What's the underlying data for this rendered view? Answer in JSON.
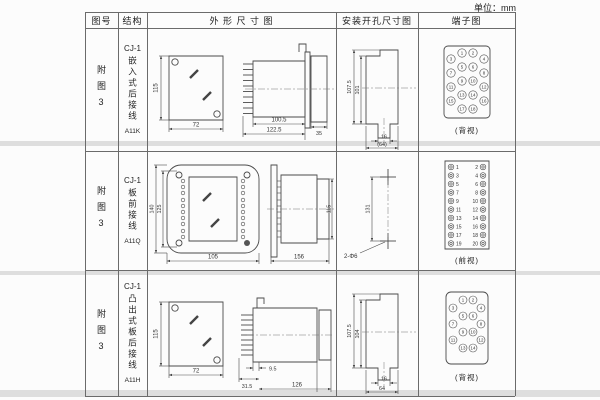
{
  "unit_label": "单位：mm",
  "header": {
    "fig_no": "图号",
    "structure": "结构",
    "outline": "外 形 尺 寸 图",
    "mounting": "安装开孔尺寸图",
    "terminal": "端子图"
  },
  "rows": [
    {
      "fig_no": "附图3",
      "model": "CJ-1",
      "structure_type": "嵌入式后接线",
      "code": "A11K",
      "outline": {
        "front_height": "115",
        "front_width": "72",
        "depth_inner": "100.5",
        "depth_outer": "122.5",
        "bezel_depth": "35"
      },
      "mounting": {
        "outer_height": "107.5",
        "inner_height": "101",
        "tab": "16",
        "width": "(64)"
      },
      "terminal": {
        "view_label": "(背视)",
        "numbers": [
          "1",
          "2",
          "3",
          "4",
          "5",
          "6",
          "7",
          "8",
          "9",
          "10",
          "11",
          "12",
          "13",
          "14",
          "15",
          "16",
          "17",
          "18"
        ]
      }
    },
    {
      "fig_no": "附图3",
      "model": "CJ-1",
      "structure_type": "板前接线",
      "code": "A11Q",
      "outline": {
        "front_height_outer": "140",
        "front_height_inner": "125",
        "front_width": "105",
        "depth": "156",
        "side_height": "115"
      },
      "mounting": {
        "hole_spacing": "131",
        "holes_label": "2-Φ6"
      },
      "terminal": {
        "view_label": "(前视)",
        "left_numbers": [
          "1",
          "3",
          "5",
          "7",
          "9",
          "11",
          "13",
          "15",
          "17",
          "19"
        ],
        "right_numbers": [
          "2",
          "4",
          "6",
          "8",
          "10",
          "12",
          "14",
          "16",
          "18",
          "20"
        ]
      }
    },
    {
      "fig_no": "附图3",
      "model": "CJ-1",
      "structure_type": "凸出式板后接线",
      "code": "A11H",
      "outline": {
        "front_height": "115",
        "front_width": "72",
        "stud_length": "31.5",
        "offset": "9.5",
        "depth": "126"
      },
      "mounting": {
        "outer_height": "107.5",
        "inner_height": "104",
        "tab": "16",
        "width": "64"
      },
      "terminal": {
        "view_label": "(背视)",
        "numbers": [
          "1",
          "2",
          "3",
          "4",
          "5",
          "6",
          "7",
          "8",
          "9",
          "10",
          "11",
          "12",
          "13",
          "14"
        ]
      }
    }
  ]
}
